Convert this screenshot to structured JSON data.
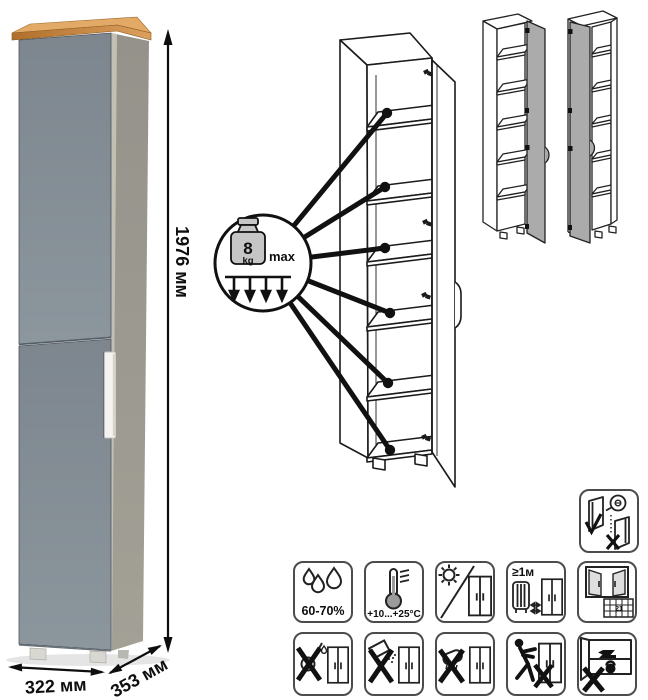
{
  "dimensions": {
    "height": "1976 мм",
    "width": "322 мм",
    "depth": "353 мм"
  },
  "load_limit": {
    "value": "8",
    "unit": "kg",
    "qualifier": "max"
  },
  "care": {
    "humidity": "60-70%",
    "temperature": "+10...+25°C",
    "min_distance_from_heat": "≥1м",
    "airing_calendar_day": "21"
  },
  "icons": {
    "row1": [
      "humidity-icon",
      "temperature-range-icon",
      "no-direct-sunlight-icon",
      "heat-source-distance-icon",
      "ventilation-icon"
    ],
    "row2": [
      "no-pouring-liquids-icon",
      "no-abrasive-cleaners-icon",
      "no-wet-cloth-icon",
      "no-pushing-icon",
      "no-heavy-objects-icon"
    ],
    "standalone": [
      "door-adjustment-icon"
    ]
  },
  "colors": {
    "front_panel": "#818a92",
    "side_panel": "#999789",
    "wood_top": "#cf8f45",
    "handle": "#f4f3f1",
    "line_art": "#1b1b1b"
  }
}
